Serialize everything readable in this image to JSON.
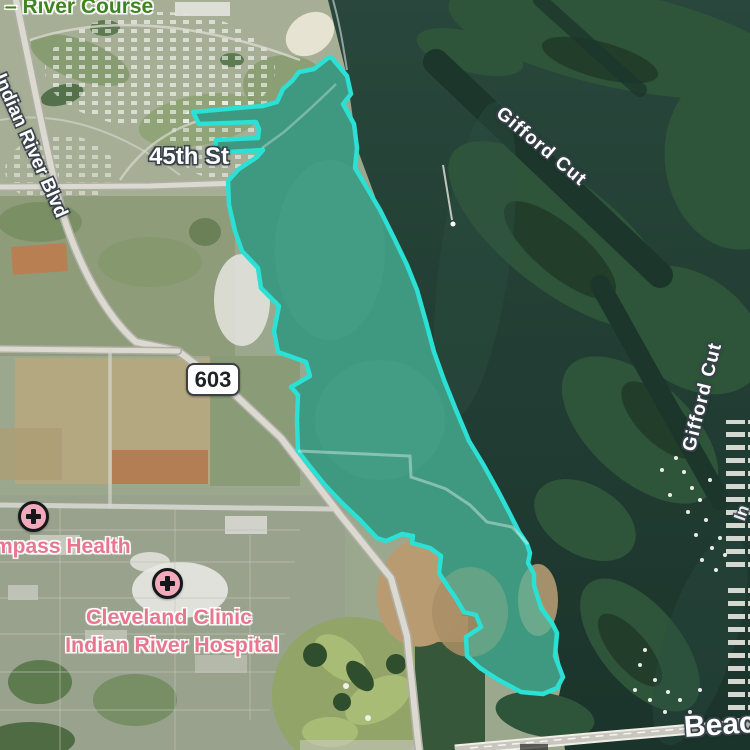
{
  "map": {
    "labels": {
      "golf_course": "– River Course",
      "blvd": "Indian River Blvd",
      "street_45th": "45th St",
      "route_603": "603",
      "gifford_cut_upper": "Gifford Cut",
      "gifford_cut_lower": "Gifford Cut",
      "compass_health": "Compass Health",
      "cleveland_clinic_line1": "Cleveland Clinic",
      "cleveland_clinic_line2": "Indian River Hospital",
      "beach_road": "Beach",
      "right_edge_partial": "In"
    },
    "icons": {
      "compass_health": "hospital-cross-icon",
      "cleveland_clinic": "hospital-cross-icon"
    },
    "colors": {
      "selection_fill": "rgba(45,185,170,0.5)",
      "selection_stroke": "#2BE0D4",
      "water": "#24423A",
      "label_green": "#3E8420",
      "label_pink": "#E8768F",
      "hospital_icon_fill": "#F2A9BC",
      "shield_background": "#FFFFFF"
    }
  }
}
